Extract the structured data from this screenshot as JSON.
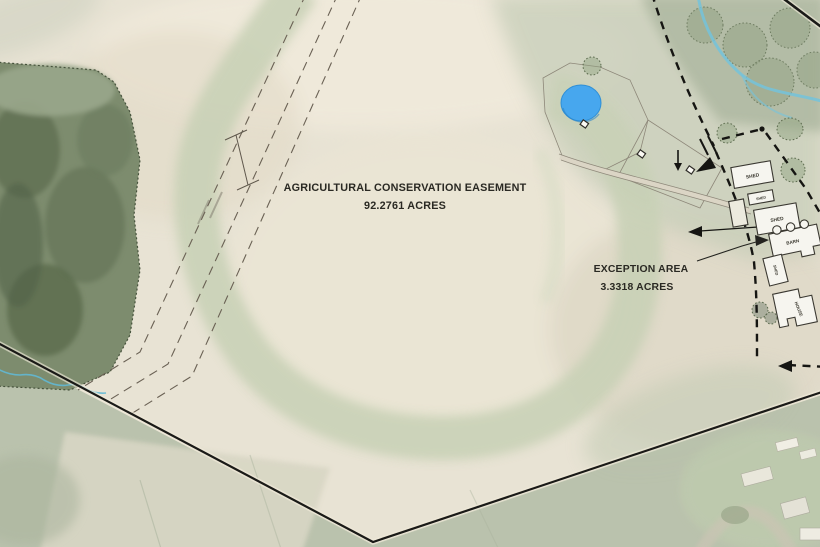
{
  "map": {
    "easement": {
      "title": "AGRICULTURAL CONSERVATION EASEMENT",
      "area": "92.2761 ACRES"
    },
    "exception": {
      "title": "EXCEPTION AREA",
      "area": "3.3318 ACRES"
    },
    "buildings": [
      {
        "label": "SHED"
      },
      {
        "label": "SHED"
      },
      {
        "label": "SHED"
      },
      {
        "label": "SHED"
      },
      {
        "label": "BARN"
      },
      {
        "label": "HOUSE"
      }
    ],
    "features": {
      "pond": "pond",
      "stream": "stream",
      "woodland": "woodland",
      "waterway": "grassed-waterway",
      "boundary": "property-boundary",
      "right_of_way": "dashed-right-of-way"
    },
    "colors": {
      "field_tan": "#e8e3d4",
      "waterway_green": "#c7d0b5",
      "woodland_green": "#6e7f60",
      "lawn_green": "#c6cdb8",
      "pond_blue": "#47a7ee",
      "stream_blue": "#74c3dc",
      "boundary_black": "#1a1a17",
      "building_white": "#f6f5ef"
    }
  }
}
